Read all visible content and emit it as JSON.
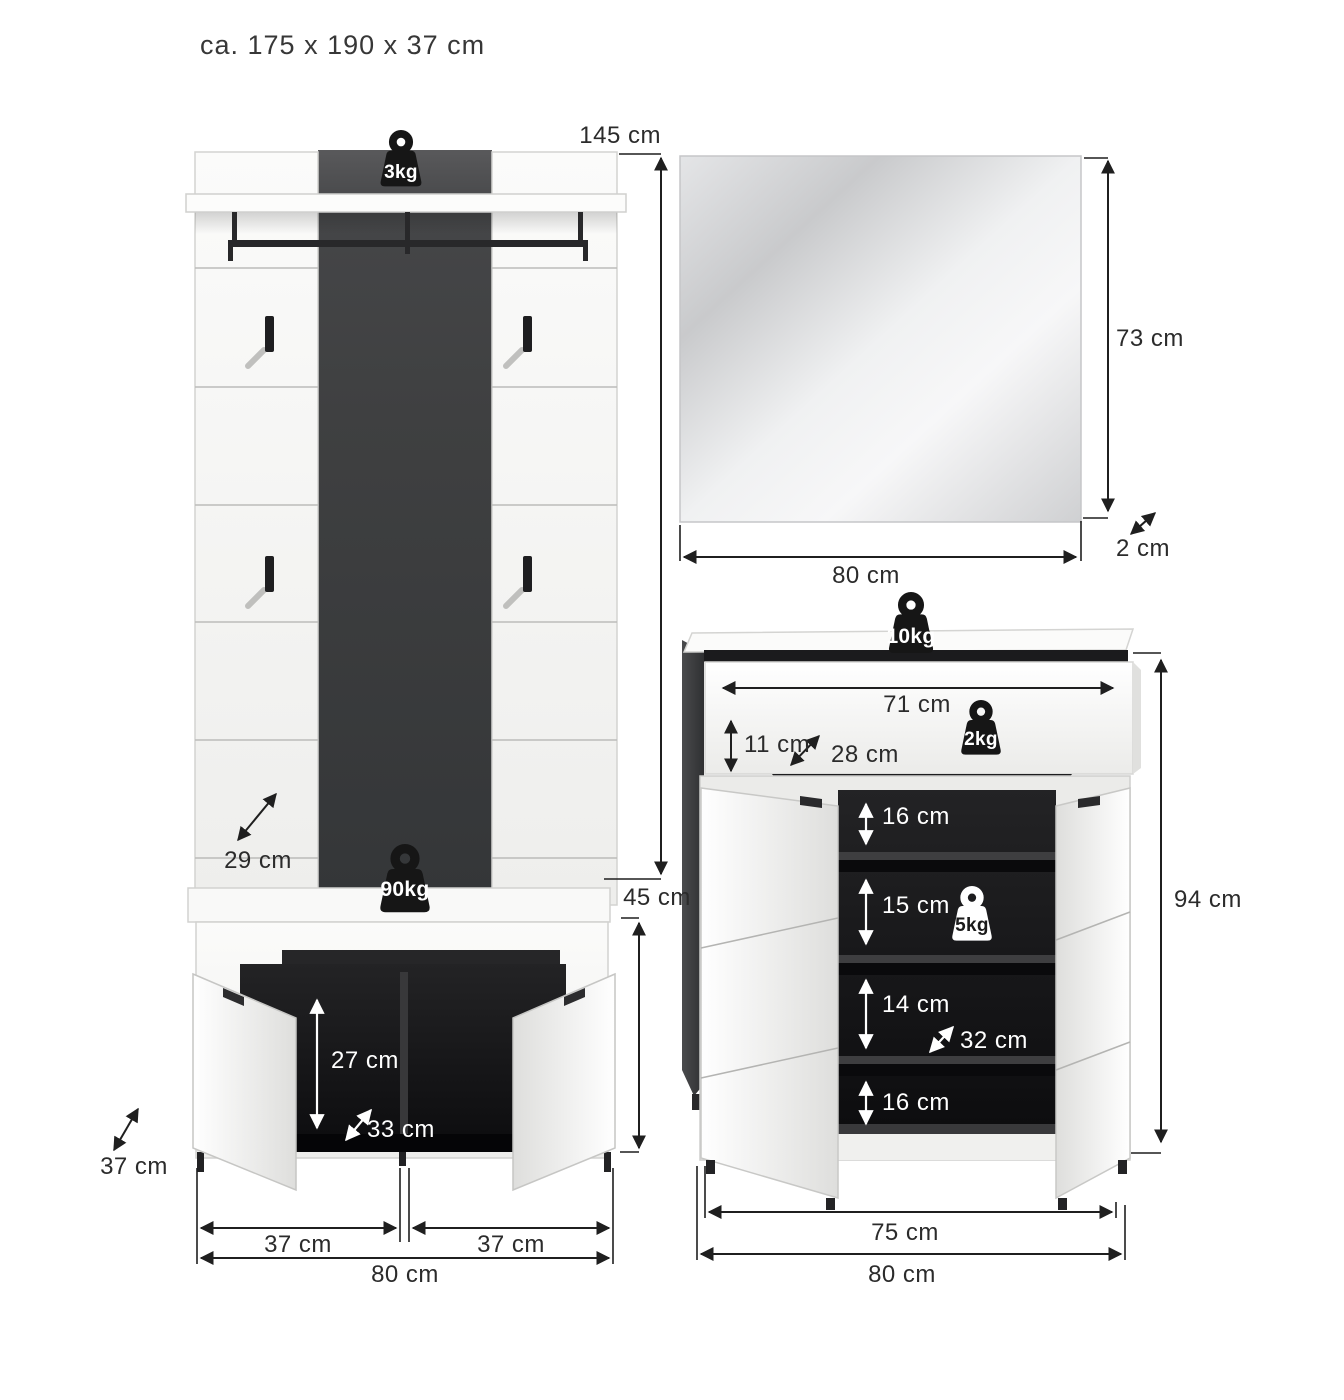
{
  "title": "ca. 175 x 190 x 37 cm",
  "wardrobe": {
    "weights": {
      "top": "3kg",
      "bench": "90kg"
    },
    "dims": {
      "panel_height": "145 cm",
      "hook_depth": "29 cm",
      "bench_height": "45 cm",
      "inner_height": "27 cm",
      "inner_depth": "33 cm",
      "depth": "37 cm",
      "left_door_width": "37 cm",
      "right_door_width": "37 cm",
      "total_width": "80 cm"
    }
  },
  "mirror": {
    "dims": {
      "height": "73 cm",
      "thickness": "2 cm",
      "width": "80 cm"
    }
  },
  "shoe_cabinet": {
    "weights": {
      "top": "10kg",
      "drawer": "2kg",
      "shelf": "5kg"
    },
    "dims": {
      "drawer_width": "71 cm",
      "drawer_height": "11 cm",
      "drawer_depth": "28 cm",
      "compartment_1": "16 cm",
      "compartment_2": "15 cm",
      "compartment_3": "14 cm",
      "compartment_4": "16 cm",
      "shelf_depth": "32 cm",
      "height": "94 cm",
      "front_width": "75 cm",
      "total_width": "80 cm"
    }
  },
  "colors": {
    "accent_dark": "#3f4041",
    "interior": "#101012",
    "line": "#1f1f1f",
    "white": "#ffffff"
  }
}
